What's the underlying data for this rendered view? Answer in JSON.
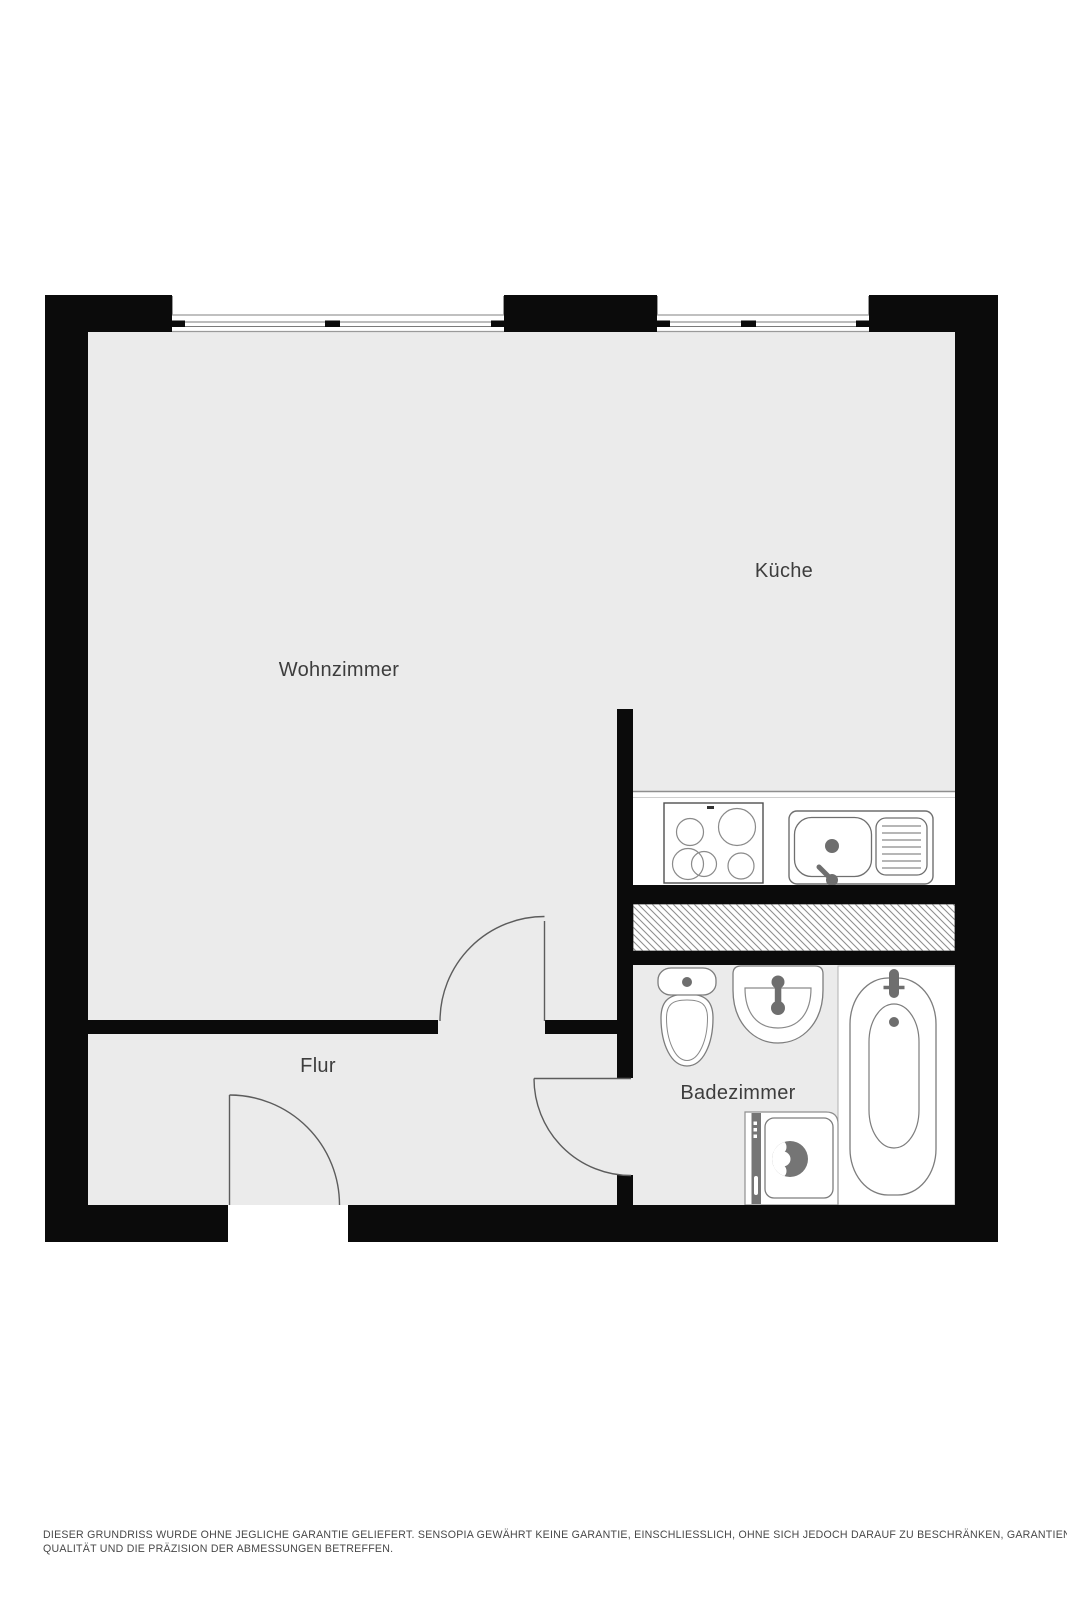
{
  "floor_plan": {
    "rooms": [
      {
        "id": "wohnzimmer",
        "label": "Wohnzimmer"
      },
      {
        "id": "kueche",
        "label": "Küche"
      },
      {
        "id": "flur",
        "label": "Flur"
      },
      {
        "id": "badezimmer",
        "label": "Badezimmer"
      }
    ],
    "fixtures": [
      "stove",
      "kitchen-sink",
      "ventilation-shaft",
      "toilet",
      "washbasin",
      "bathtub",
      "washing-machine"
    ],
    "doors": [
      "living-room-door",
      "entrance-door",
      "bathroom-door"
    ],
    "windows": [
      "window-left",
      "window-right"
    ],
    "colors": {
      "wall": "#0b0b0b",
      "floor": "#ebebeb",
      "fixture_fill": "#ffffff",
      "fixture_outline": "#7d7d7d",
      "fixture_accent": "#6e6e6e",
      "door_line": "#5c5c5c",
      "window_line": "#9a9a9a",
      "hatch_line": "#8f8f8f",
      "label_text": "#3d3d3d"
    }
  },
  "disclaimer": {
    "line1": "DIESER GRUNDRISS WURDE OHNE JEGLICHE GARANTIE GELIEFERT. SENSOPIA GEWÄHRT KEINE GARANTIE, EINSCHLIESSLICH, OHNE SICH JEDOCH DARAUF ZU BESCHRÄNKEN, GARANTIEN, DIE DIE",
    "line2": "QUALITÄT UND DIE PRÄZISION DER ABMESSUNGEN BETREFFEN."
  }
}
